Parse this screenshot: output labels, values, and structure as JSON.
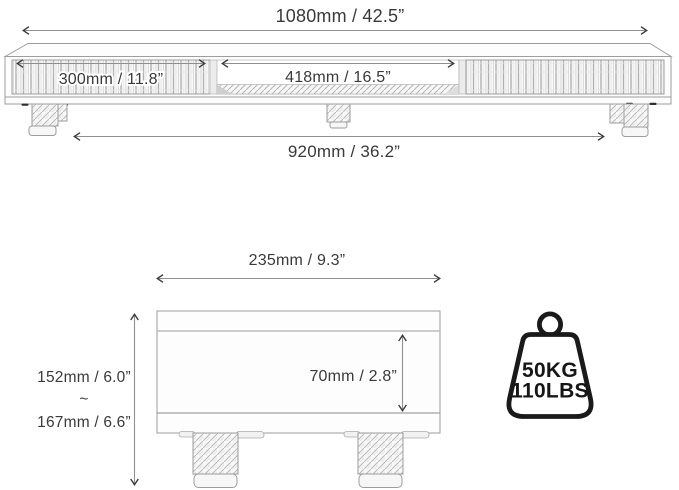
{
  "front_view": {
    "overall_width_label": "1080mm / 42.5”",
    "left_drawer_width_label": "300mm / 11.8”",
    "open_shelf_width_label": "418mm / 16.5”",
    "leg_span_label": "920mm / 36.2”"
  },
  "side_view": {
    "depth_label": "235mm / 9.3”",
    "min_height_label": "152mm / 6.0”",
    "range_separator": "~",
    "max_height_label": "167mm / 6.6”",
    "shelf_clearance_label": "70mm / 2.8”"
  },
  "weight_capacity": {
    "kilograms": "50KG",
    "pounds": "110LBS"
  },
  "colors": {
    "background": "#ffffff",
    "dimension_text": "#3a3a3a",
    "dimension_line": "#8f8f8f",
    "arrowhead": "#3c3c3c",
    "sketch_outline": "#9d9d9d",
    "weight_icon": "#1a1a1a"
  }
}
